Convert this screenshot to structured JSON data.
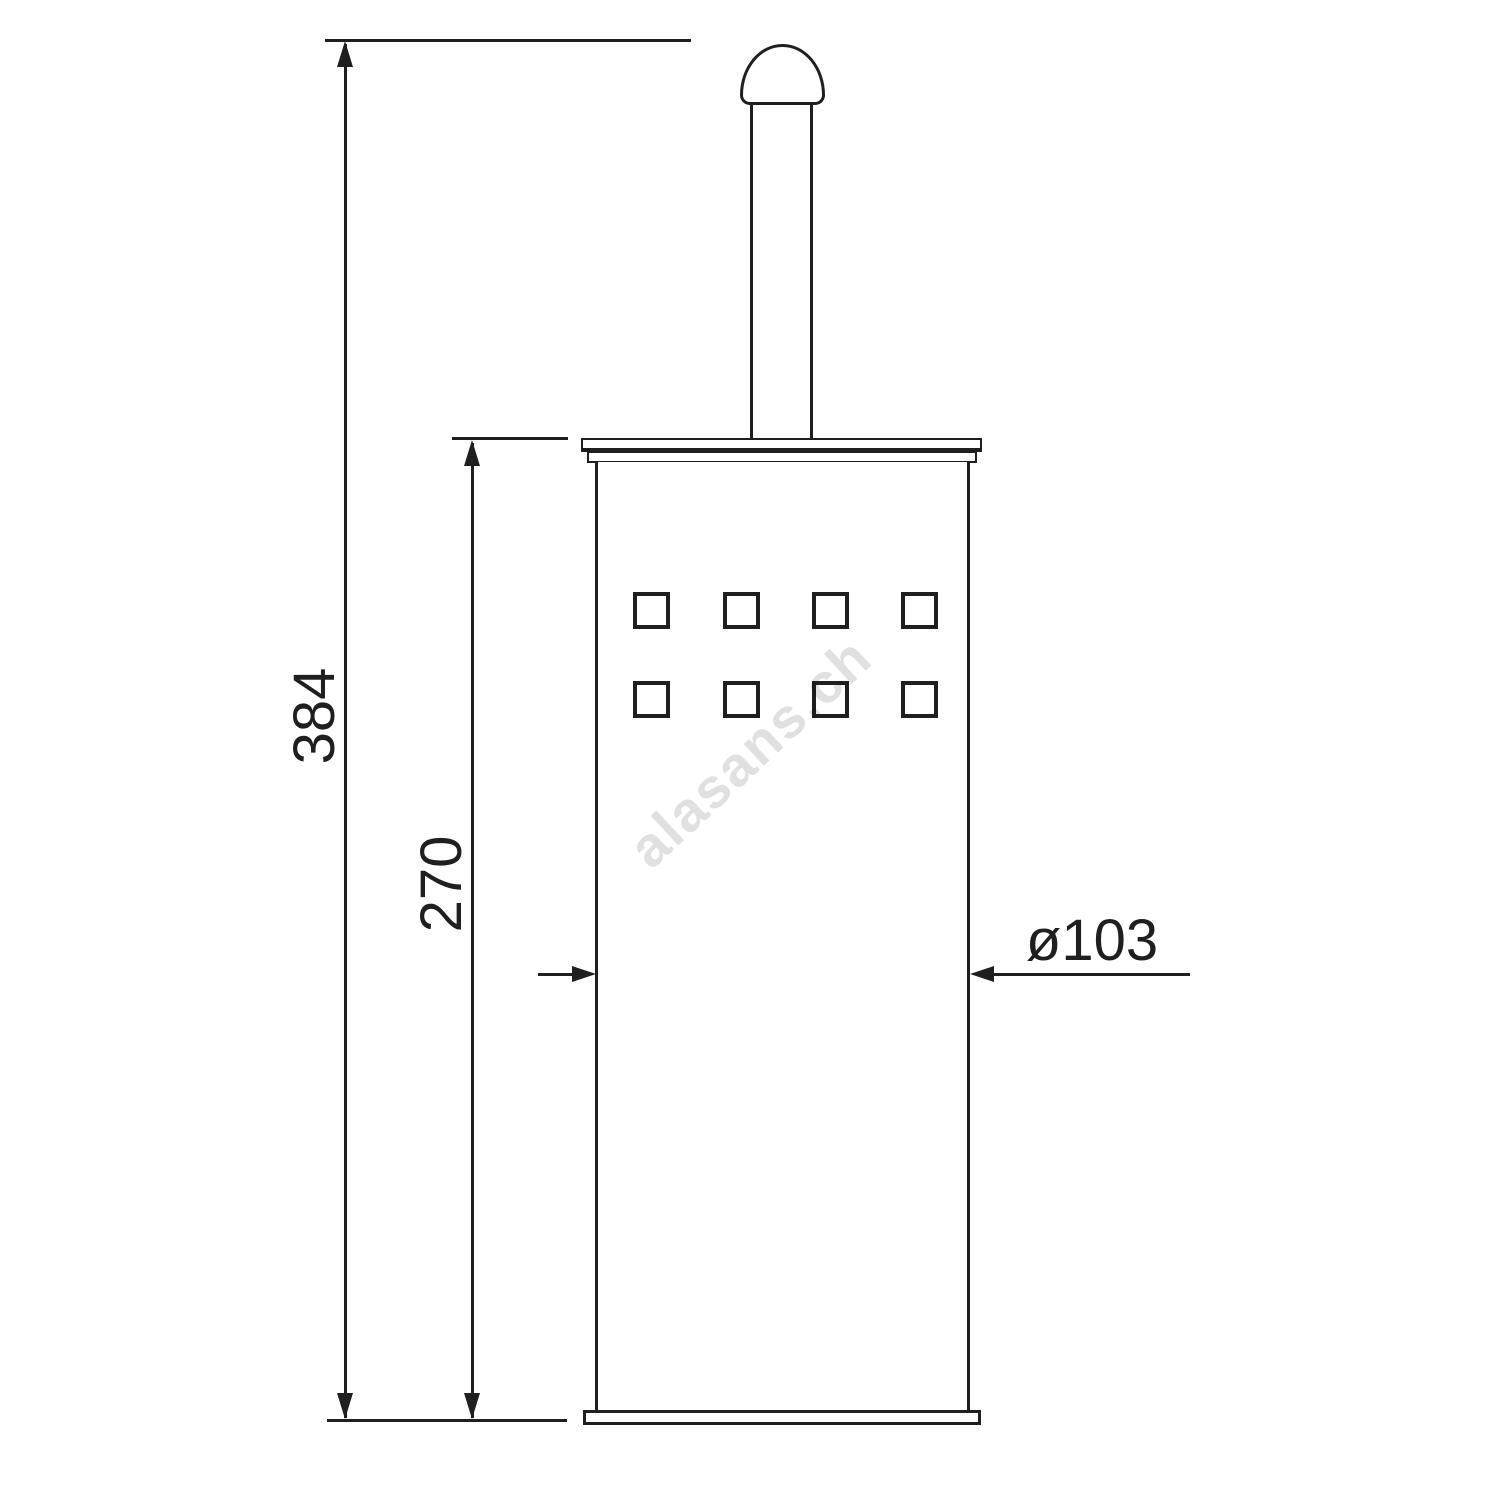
{
  "canvas": {
    "width": 1500,
    "height": 1500,
    "background": "#ffffff"
  },
  "drawing": {
    "line_color": "#1f1f1f",
    "watermark": {
      "text": "alasans.ch",
      "color": "#e0e0e0"
    },
    "dimensions": {
      "total_height": {
        "label": "384"
      },
      "body_height": {
        "label": "270"
      },
      "diameter": {
        "label": "ø103"
      }
    },
    "perforation": {
      "rows": 2,
      "columns": 4
    }
  }
}
